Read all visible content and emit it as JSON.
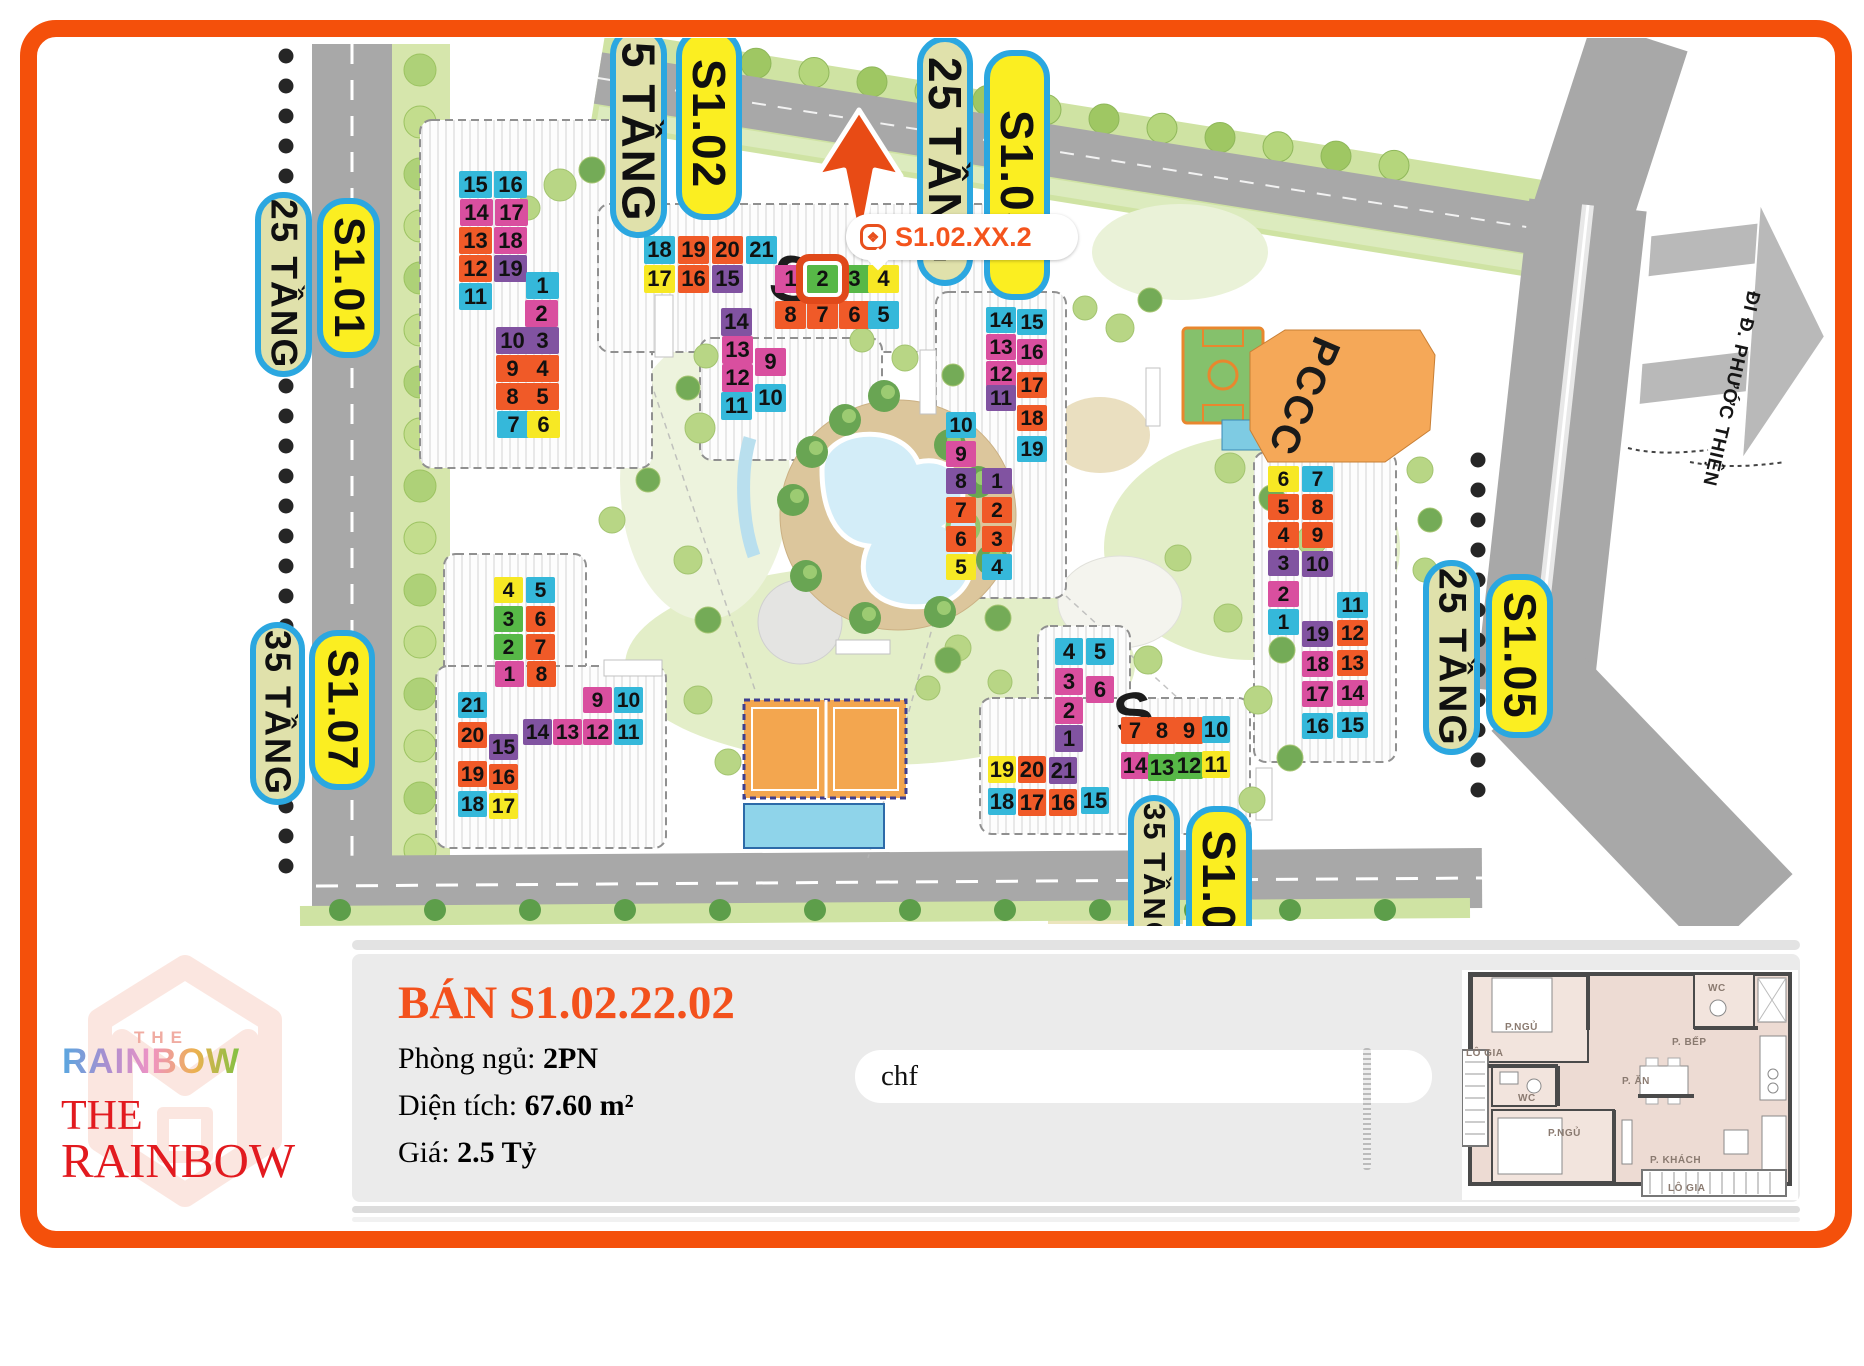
{
  "map": {
    "callout": {
      "text": "S1.02.XX.2",
      "icon": "rainbow-badge-icon"
    },
    "pccc_label": "PCCC",
    "road_sign": "ĐI Đ. PHƯỚC THIỆN",
    "roof_letters": [
      "S",
      "S"
    ],
    "labels": [
      {
        "text": "25 TẦNG",
        "kind": "floors",
        "x": 255,
        "y": 192,
        "w": 57,
        "h": 185
      },
      {
        "text": "S1.01",
        "kind": "name",
        "x": 317,
        "y": 198,
        "w": 63,
        "h": 160
      },
      {
        "text": "35 TẦNG",
        "kind": "floors",
        "x": 250,
        "y": 622,
        "w": 55,
        "h": 183
      },
      {
        "text": "S1.07",
        "kind": "name",
        "x": 309,
        "y": 630,
        "w": 66,
        "h": 160
      },
      {
        "text": "5 TẦNG",
        "kind": "floors",
        "x": 610,
        "y": 26,
        "w": 57,
        "h": 212
      },
      {
        "text": "S1.02",
        "kind": "name",
        "x": 676,
        "y": 28,
        "w": 66,
        "h": 192
      },
      {
        "text": "25 TẦNG",
        "kind": "floors",
        "x": 917,
        "y": 36,
        "w": 56,
        "h": 250
      },
      {
        "text": "S1.03",
        "kind": "name",
        "x": 984,
        "y": 50,
        "w": 66,
        "h": 250
      },
      {
        "text": "25 TẦNG",
        "kind": "floors",
        "x": 1423,
        "y": 560,
        "w": 57,
        "h": 195
      },
      {
        "text": "S1.05",
        "kind": "name",
        "x": 1486,
        "y": 574,
        "w": 67,
        "h": 164
      },
      {
        "text": "35 TẦNG",
        "kind": "floors",
        "x": 1128,
        "y": 795,
        "w": 52,
        "h": 160
      },
      {
        "text": "S1.0",
        "kind": "name",
        "x": 1186,
        "y": 806,
        "w": 66,
        "h": 150
      }
    ],
    "buildings": [
      {
        "id": "S1.01",
        "cell_w": 33,
        "cell_h": 27,
        "cells": [
          {
            "n": "15",
            "c": "cyan",
            "x": 459,
            "y": 171
          },
          {
            "n": "16",
            "c": "cyan",
            "x": 494,
            "y": 171
          },
          {
            "n": "14",
            "c": "pink",
            "x": 460,
            "y": 199
          },
          {
            "n": "17",
            "c": "pink",
            "x": 495,
            "y": 199
          },
          {
            "n": "13",
            "c": "orange",
            "x": 459,
            "y": 227
          },
          {
            "n": "18",
            "c": "pink",
            "x": 494,
            "y": 227
          },
          {
            "n": "12",
            "c": "orange",
            "x": 459,
            "y": 255
          },
          {
            "n": "19",
            "c": "purple",
            "x": 494,
            "y": 255
          },
          {
            "n": "11",
            "c": "cyan",
            "x": 459,
            "y": 283
          },
          {
            "n": "1",
            "c": "cyan",
            "x": 526,
            "y": 272
          },
          {
            "n": "2",
            "c": "pink",
            "x": 525,
            "y": 300
          },
          {
            "n": "10",
            "c": "purple",
            "x": 496,
            "y": 327
          },
          {
            "n": "3",
            "c": "purple",
            "x": 526,
            "y": 327
          },
          {
            "n": "9",
            "c": "orange",
            "x": 496,
            "y": 355
          },
          {
            "n": "4",
            "c": "orange",
            "x": 526,
            "y": 355
          },
          {
            "n": "8",
            "c": "orange",
            "x": 496,
            "y": 383
          },
          {
            "n": "5",
            "c": "orange",
            "x": 526,
            "y": 383
          },
          {
            "n": "7",
            "c": "cyan",
            "x": 497,
            "y": 411
          },
          {
            "n": "6",
            "c": "yellow",
            "x": 527,
            "y": 411
          }
        ]
      },
      {
        "id": "S1.02",
        "cell_w": 31,
        "cell_h": 28,
        "cells": [
          {
            "n": "18",
            "c": "cyan",
            "x": 644,
            "y": 236
          },
          {
            "n": "19",
            "c": "orange",
            "x": 678,
            "y": 236
          },
          {
            "n": "20",
            "c": "orange",
            "x": 712,
            "y": 236
          },
          {
            "n": "21",
            "c": "cyan",
            "x": 746,
            "y": 236
          },
          {
            "n": "17",
            "c": "yellow",
            "x": 644,
            "y": 265
          },
          {
            "n": "16",
            "c": "orange",
            "x": 678,
            "y": 265
          },
          {
            "n": "15",
            "c": "purple",
            "x": 712,
            "y": 265
          },
          {
            "n": "1",
            "c": "pink",
            "x": 775,
            "y": 265
          },
          {
            "n": "2",
            "c": "green",
            "x": 807,
            "y": 265,
            "hl": true
          },
          {
            "n": "3",
            "c": "green",
            "x": 839,
            "y": 265
          },
          {
            "n": "4",
            "c": "yellow",
            "x": 868,
            "y": 265
          },
          {
            "n": "8",
            "c": "orange",
            "x": 775,
            "y": 301
          },
          {
            "n": "7",
            "c": "orange",
            "x": 807,
            "y": 301
          },
          {
            "n": "6",
            "c": "orange",
            "x": 839,
            "y": 301
          },
          {
            "n": "5",
            "c": "cyan",
            "x": 868,
            "y": 301
          },
          {
            "n": "14",
            "c": "purple",
            "x": 721,
            "y": 308
          },
          {
            "n": "13",
            "c": "pink",
            "x": 722,
            "y": 336
          },
          {
            "n": "9",
            "c": "pink",
            "x": 755,
            "y": 348
          },
          {
            "n": "12",
            "c": "pink",
            "x": 722,
            "y": 364
          },
          {
            "n": "11",
            "c": "cyan",
            "x": 721,
            "y": 392
          },
          {
            "n": "10",
            "c": "cyan",
            "x": 755,
            "y": 384
          }
        ]
      },
      {
        "id": "S1.03",
        "cell_w": 30,
        "cell_h": 26,
        "cells": [
          {
            "n": "14",
            "c": "cyan",
            "x": 986,
            "y": 307
          },
          {
            "n": "15",
            "c": "cyan",
            "x": 1017,
            "y": 309
          },
          {
            "n": "13",
            "c": "pink",
            "x": 986,
            "y": 334
          },
          {
            "n": "16",
            "c": "pink",
            "x": 1017,
            "y": 339
          },
          {
            "n": "12",
            "c": "pink",
            "x": 986,
            "y": 361
          },
          {
            "n": "17",
            "c": "orange",
            "x": 1017,
            "y": 372
          },
          {
            "n": "11",
            "c": "purple",
            "x": 986,
            "y": 385
          },
          {
            "n": "18",
            "c": "orange",
            "x": 1017,
            "y": 405
          },
          {
            "n": "19",
            "c": "cyan",
            "x": 1017,
            "y": 436
          },
          {
            "n": "10",
            "c": "cyan",
            "x": 946,
            "y": 412
          },
          {
            "n": "9",
            "c": "pink",
            "x": 946,
            "y": 441
          },
          {
            "n": "8",
            "c": "purple",
            "x": 946,
            "y": 468
          },
          {
            "n": "1",
            "c": "purple",
            "x": 982,
            "y": 468
          },
          {
            "n": "7",
            "c": "orange",
            "x": 946,
            "y": 497
          },
          {
            "n": "2",
            "c": "orange",
            "x": 982,
            "y": 497
          },
          {
            "n": "6",
            "c": "orange",
            "x": 946,
            "y": 526
          },
          {
            "n": "3",
            "c": "orange",
            "x": 982,
            "y": 526
          },
          {
            "n": "5",
            "c": "yellow",
            "x": 946,
            "y": 554
          },
          {
            "n": "4",
            "c": "cyan",
            "x": 982,
            "y": 554
          }
        ]
      },
      {
        "id": "S1.05",
        "cell_w": 31,
        "cell_h": 26,
        "cells": [
          {
            "n": "6",
            "c": "yellow",
            "x": 1268,
            "y": 466
          },
          {
            "n": "7",
            "c": "cyan",
            "x": 1302,
            "y": 466
          },
          {
            "n": "5",
            "c": "orange",
            "x": 1268,
            "y": 494
          },
          {
            "n": "8",
            "c": "orange",
            "x": 1302,
            "y": 494
          },
          {
            "n": "4",
            "c": "orange",
            "x": 1268,
            "y": 522
          },
          {
            "n": "9",
            "c": "orange",
            "x": 1302,
            "y": 522
          },
          {
            "n": "3",
            "c": "purple",
            "x": 1268,
            "y": 550
          },
          {
            "n": "10",
            "c": "purple",
            "x": 1302,
            "y": 551
          },
          {
            "n": "2",
            "c": "pink",
            "x": 1268,
            "y": 581
          },
          {
            "n": "1",
            "c": "cyan",
            "x": 1268,
            "y": 609
          },
          {
            "n": "11",
            "c": "cyan",
            "x": 1337,
            "y": 592
          },
          {
            "n": "19",
            "c": "purple",
            "x": 1302,
            "y": 621
          },
          {
            "n": "12",
            "c": "orange",
            "x": 1337,
            "y": 620
          },
          {
            "n": "18",
            "c": "pink",
            "x": 1302,
            "y": 651
          },
          {
            "n": "13",
            "c": "orange",
            "x": 1337,
            "y": 650
          },
          {
            "n": "17",
            "c": "pink",
            "x": 1302,
            "y": 681
          },
          {
            "n": "14",
            "c": "pink",
            "x": 1337,
            "y": 680
          },
          {
            "n": "16",
            "c": "cyan",
            "x": 1302,
            "y": 713
          },
          {
            "n": "15",
            "c": "cyan",
            "x": 1337,
            "y": 712
          }
        ]
      },
      {
        "id": "S1.07",
        "cell_w": 29,
        "cell_h": 26,
        "cells": [
          {
            "n": "4",
            "c": "yellow",
            "x": 494,
            "y": 577
          },
          {
            "n": "5",
            "c": "cyan",
            "x": 526,
            "y": 577
          },
          {
            "n": "3",
            "c": "green",
            "x": 494,
            "y": 606
          },
          {
            "n": "6",
            "c": "orange",
            "x": 526,
            "y": 606
          },
          {
            "n": "2",
            "c": "green",
            "x": 494,
            "y": 634
          },
          {
            "n": "7",
            "c": "orange",
            "x": 526,
            "y": 634
          },
          {
            "n": "1",
            "c": "pink",
            "x": 495,
            "y": 661
          },
          {
            "n": "8",
            "c": "orange",
            "x": 527,
            "y": 661
          },
          {
            "n": "9",
            "c": "pink",
            "x": 583,
            "y": 687
          },
          {
            "n": "10",
            "c": "cyan",
            "x": 614,
            "y": 687
          },
          {
            "n": "14",
            "c": "purple",
            "x": 523,
            "y": 719
          },
          {
            "n": "13",
            "c": "pink",
            "x": 553,
            "y": 719
          },
          {
            "n": "12",
            "c": "pink",
            "x": 583,
            "y": 719
          },
          {
            "n": "11",
            "c": "cyan",
            "x": 614,
            "y": 719
          },
          {
            "n": "21",
            "c": "cyan",
            "x": 458,
            "y": 692
          },
          {
            "n": "20",
            "c": "orange",
            "x": 458,
            "y": 722
          },
          {
            "n": "15",
            "c": "purple",
            "x": 489,
            "y": 734
          },
          {
            "n": "19",
            "c": "orange",
            "x": 458,
            "y": 761
          },
          {
            "n": "16",
            "c": "orange",
            "x": 489,
            "y": 764
          },
          {
            "n": "18",
            "c": "cyan",
            "x": 458,
            "y": 791
          },
          {
            "n": "17",
            "c": "yellow",
            "x": 489,
            "y": 793
          }
        ]
      },
      {
        "id": "S1.04",
        "cell_w": 28,
        "cell_h": 27,
        "cells": [
          {
            "n": "4",
            "c": "cyan",
            "x": 1055,
            "y": 638
          },
          {
            "n": "5",
            "c": "cyan",
            "x": 1086,
            "y": 638
          },
          {
            "n": "3",
            "c": "pink",
            "x": 1055,
            "y": 668
          },
          {
            "n": "6",
            "c": "pink",
            "x": 1086,
            "y": 676
          },
          {
            "n": "2",
            "c": "pink",
            "x": 1055,
            "y": 697
          },
          {
            "n": "1",
            "c": "purple",
            "x": 1055,
            "y": 725
          },
          {
            "n": "7",
            "c": "orange",
            "x": 1121,
            "y": 717
          },
          {
            "n": "8",
            "c": "orange",
            "x": 1148,
            "y": 717
          },
          {
            "n": "9",
            "c": "orange",
            "x": 1175,
            "y": 717
          },
          {
            "n": "10",
            "c": "cyan",
            "x": 1202,
            "y": 716
          },
          {
            "n": "14",
            "c": "pink",
            "x": 1121,
            "y": 752
          },
          {
            "n": "13",
            "c": "green",
            "x": 1148,
            "y": 754
          },
          {
            "n": "12",
            "c": "green",
            "x": 1175,
            "y": 752
          },
          {
            "n": "11",
            "c": "yellow",
            "x": 1202,
            "y": 751
          },
          {
            "n": "19",
            "c": "yellow",
            "x": 988,
            "y": 756
          },
          {
            "n": "20",
            "c": "orange",
            "x": 1018,
            "y": 756
          },
          {
            "n": "21",
            "c": "purple",
            "x": 1049,
            "y": 757
          },
          {
            "n": "18",
            "c": "cyan",
            "x": 988,
            "y": 788
          },
          {
            "n": "17",
            "c": "orange",
            "x": 1018,
            "y": 789
          },
          {
            "n": "16",
            "c": "orange",
            "x": 1049,
            "y": 789
          },
          {
            "n": "15",
            "c": "cyan",
            "x": 1081,
            "y": 787
          }
        ]
      }
    ]
  },
  "panel": {
    "title": "BÁN S1.02.22.02",
    "fields": [
      {
        "label": "Phòng ngủ: ",
        "value": "2PN"
      },
      {
        "label": "Diện tích: ",
        "value": "67.60 m²"
      },
      {
        "label": "Giá: ",
        "value": "2.5 Tỷ"
      }
    ],
    "input_value": "chf"
  },
  "logo": {
    "the_small": "THE",
    "rainbow_gradient": "RAINBOW",
    "the_red": "THE",
    "rainbow_red": "RAINBOW"
  },
  "floorplan": {
    "rooms": [
      {
        "name": "P.NGỦ",
        "x": 43,
        "y": 52
      },
      {
        "name": "WC",
        "x": 246,
        "y": 13
      },
      {
        "name": "P. BẾP",
        "x": 210,
        "y": 67
      },
      {
        "name": "LÔ GIA",
        "x": 4,
        "y": 78
      },
      {
        "name": "P. ĂN",
        "x": 160,
        "y": 106
      },
      {
        "name": "WC",
        "x": 56,
        "y": 123
      },
      {
        "name": "P.NGỦ",
        "x": 86,
        "y": 158
      },
      {
        "name": "P. KHÁCH",
        "x": 188,
        "y": 185
      },
      {
        "name": "LÔ GIA",
        "x": 206,
        "y": 213
      }
    ]
  }
}
